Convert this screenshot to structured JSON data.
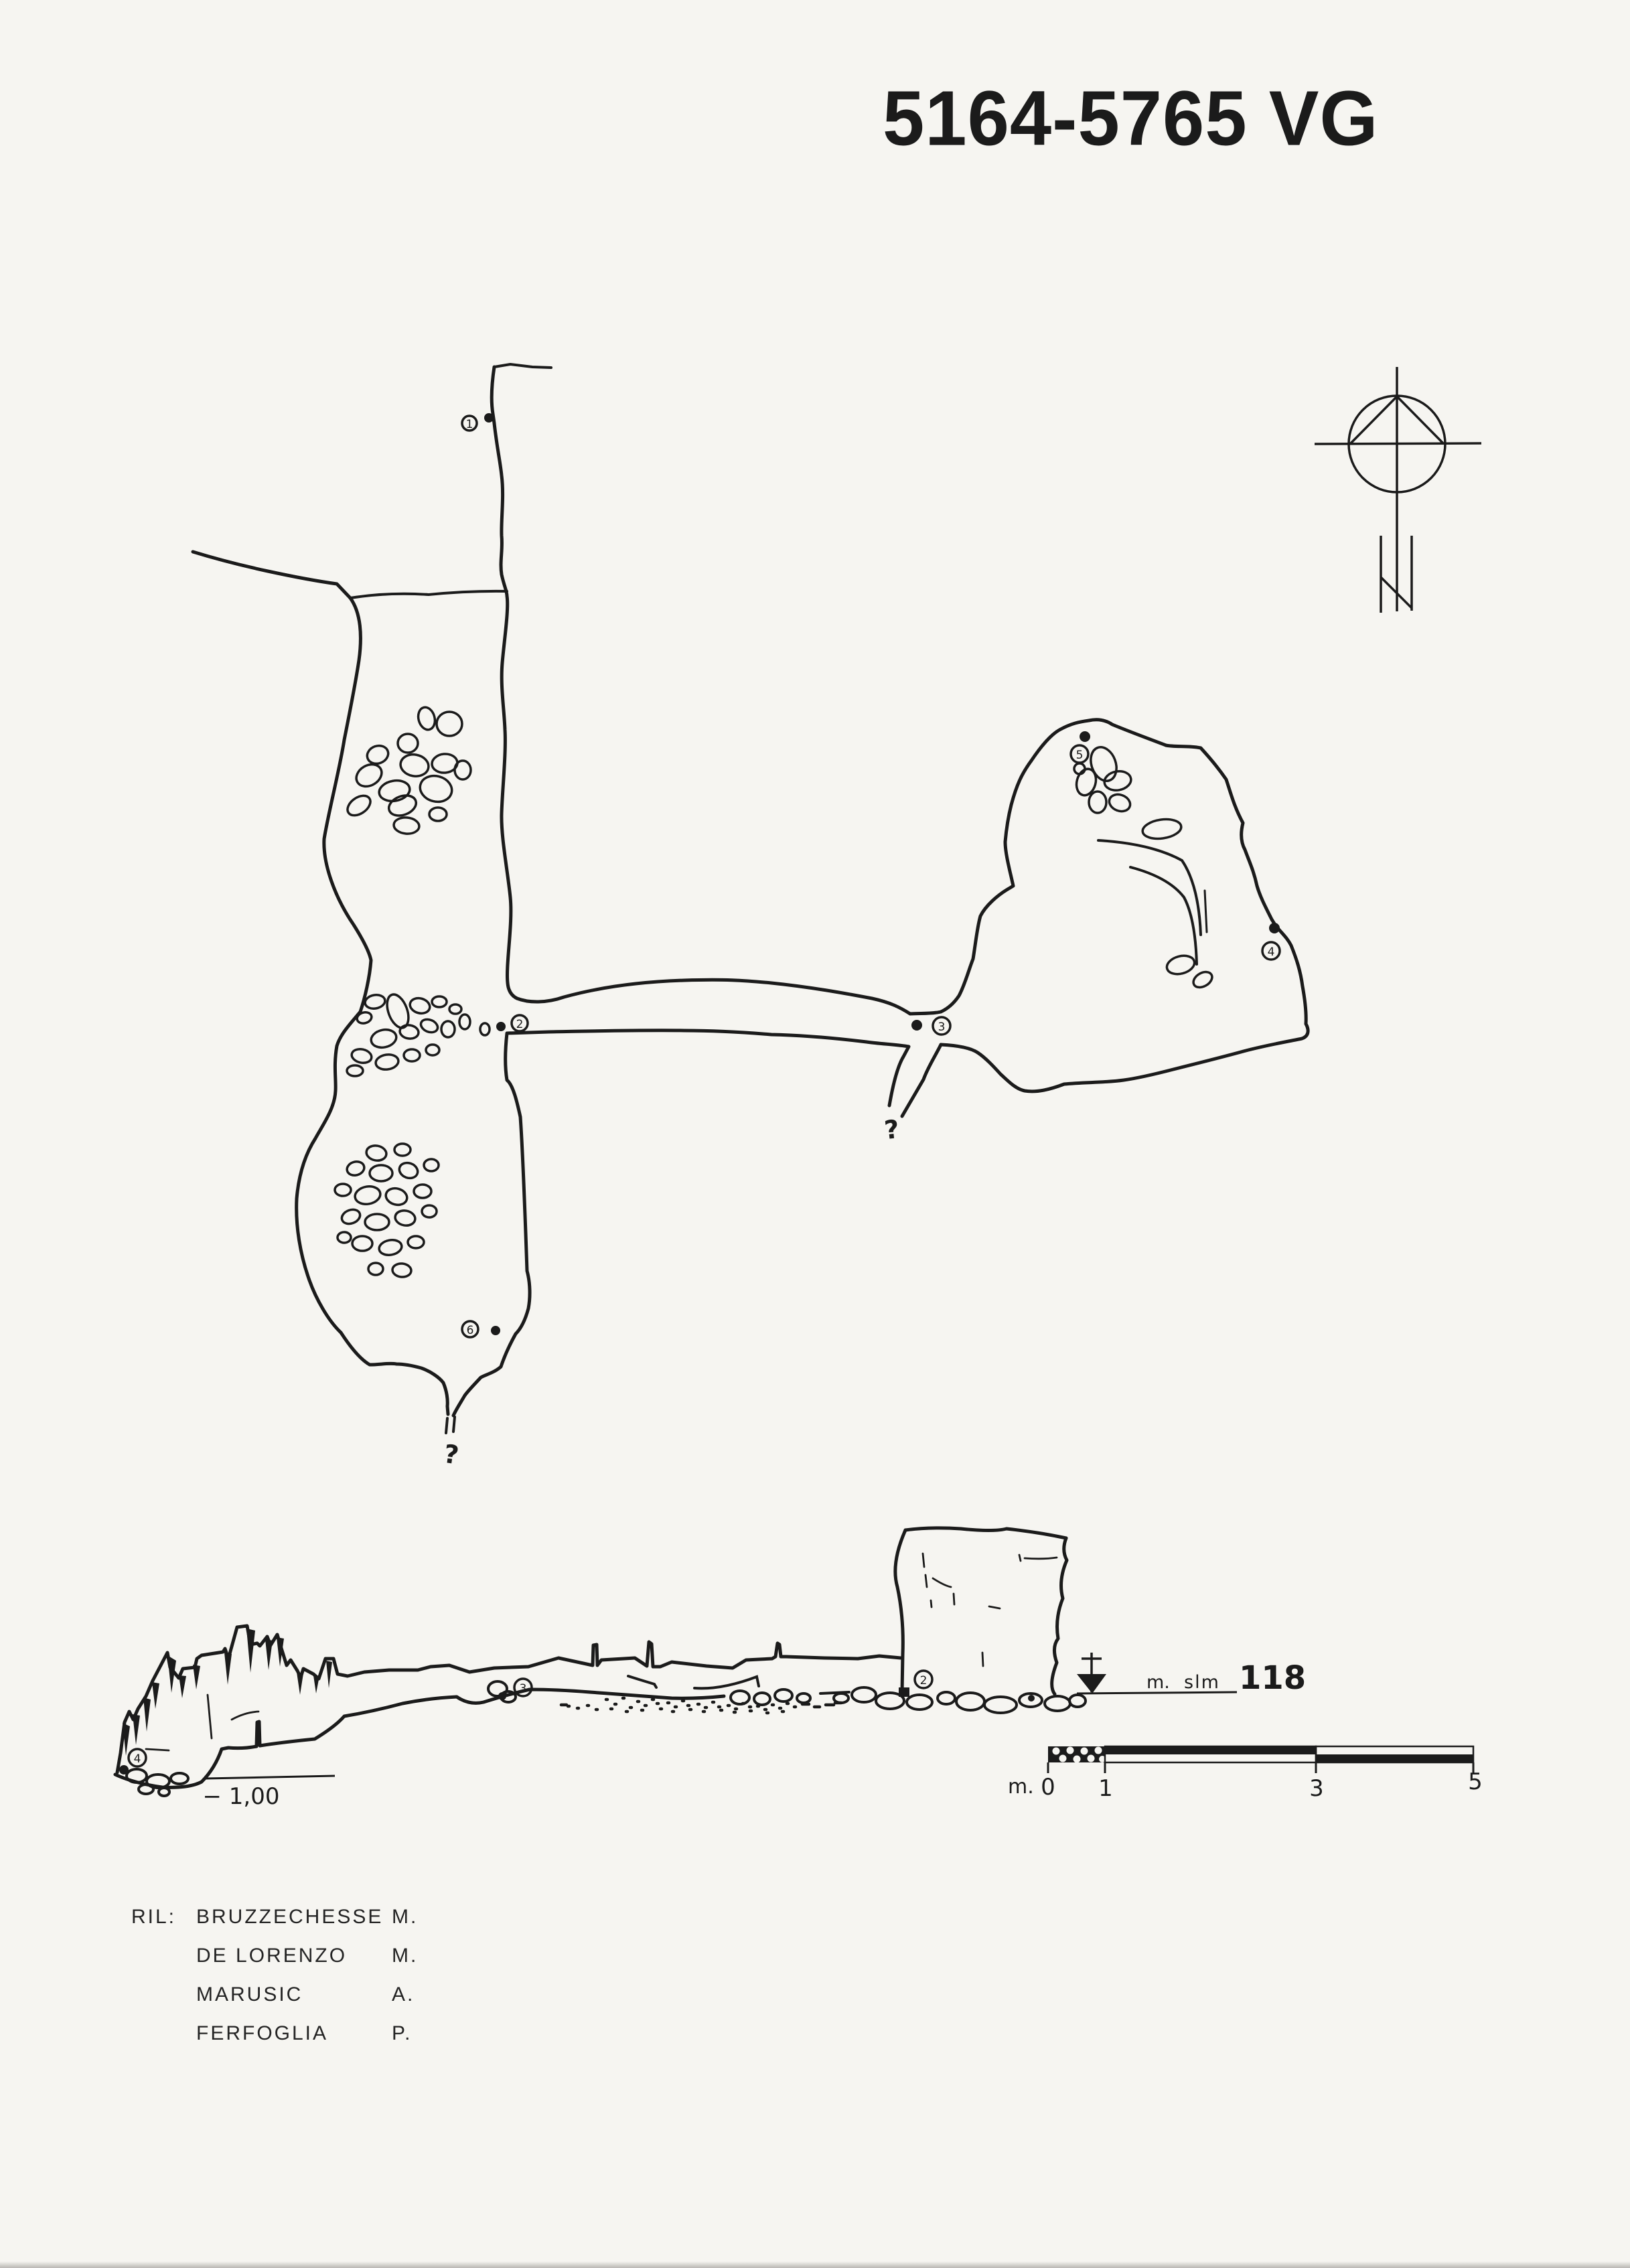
{
  "title": "5164-5765 VG",
  "plan": {
    "stations": [
      {
        "label": "1"
      },
      {
        "label": "2"
      },
      {
        "label": "3"
      },
      {
        "label": "4"
      },
      {
        "label": "5"
      },
      {
        "label": "6"
      }
    ],
    "unknown_marks": [
      "?",
      "?"
    ]
  },
  "section": {
    "stations": [
      {
        "label": "4"
      },
      {
        "label": "3"
      },
      {
        "label": "2"
      }
    ],
    "depth_label": "− 1,00",
    "elevation": {
      "prefix": "m.",
      "unit": "slm",
      "value": "118"
    }
  },
  "scale_bar": {
    "unit_label": "m.",
    "ticks": [
      "0",
      "1",
      "3",
      "5"
    ]
  },
  "credits": {
    "label": "RIL:",
    "surveyors": [
      {
        "name": "BRUZZECHESSE",
        "initial": "M."
      },
      {
        "name": "DE LORENZO",
        "initial": "M."
      },
      {
        "name": "MARUSIC",
        "initial": "A."
      },
      {
        "name": "FERFOGLIA",
        "initial": "P."
      }
    ]
  },
  "colors": {
    "ink": "#1b1b1b",
    "paper": "#f6f5f1"
  }
}
